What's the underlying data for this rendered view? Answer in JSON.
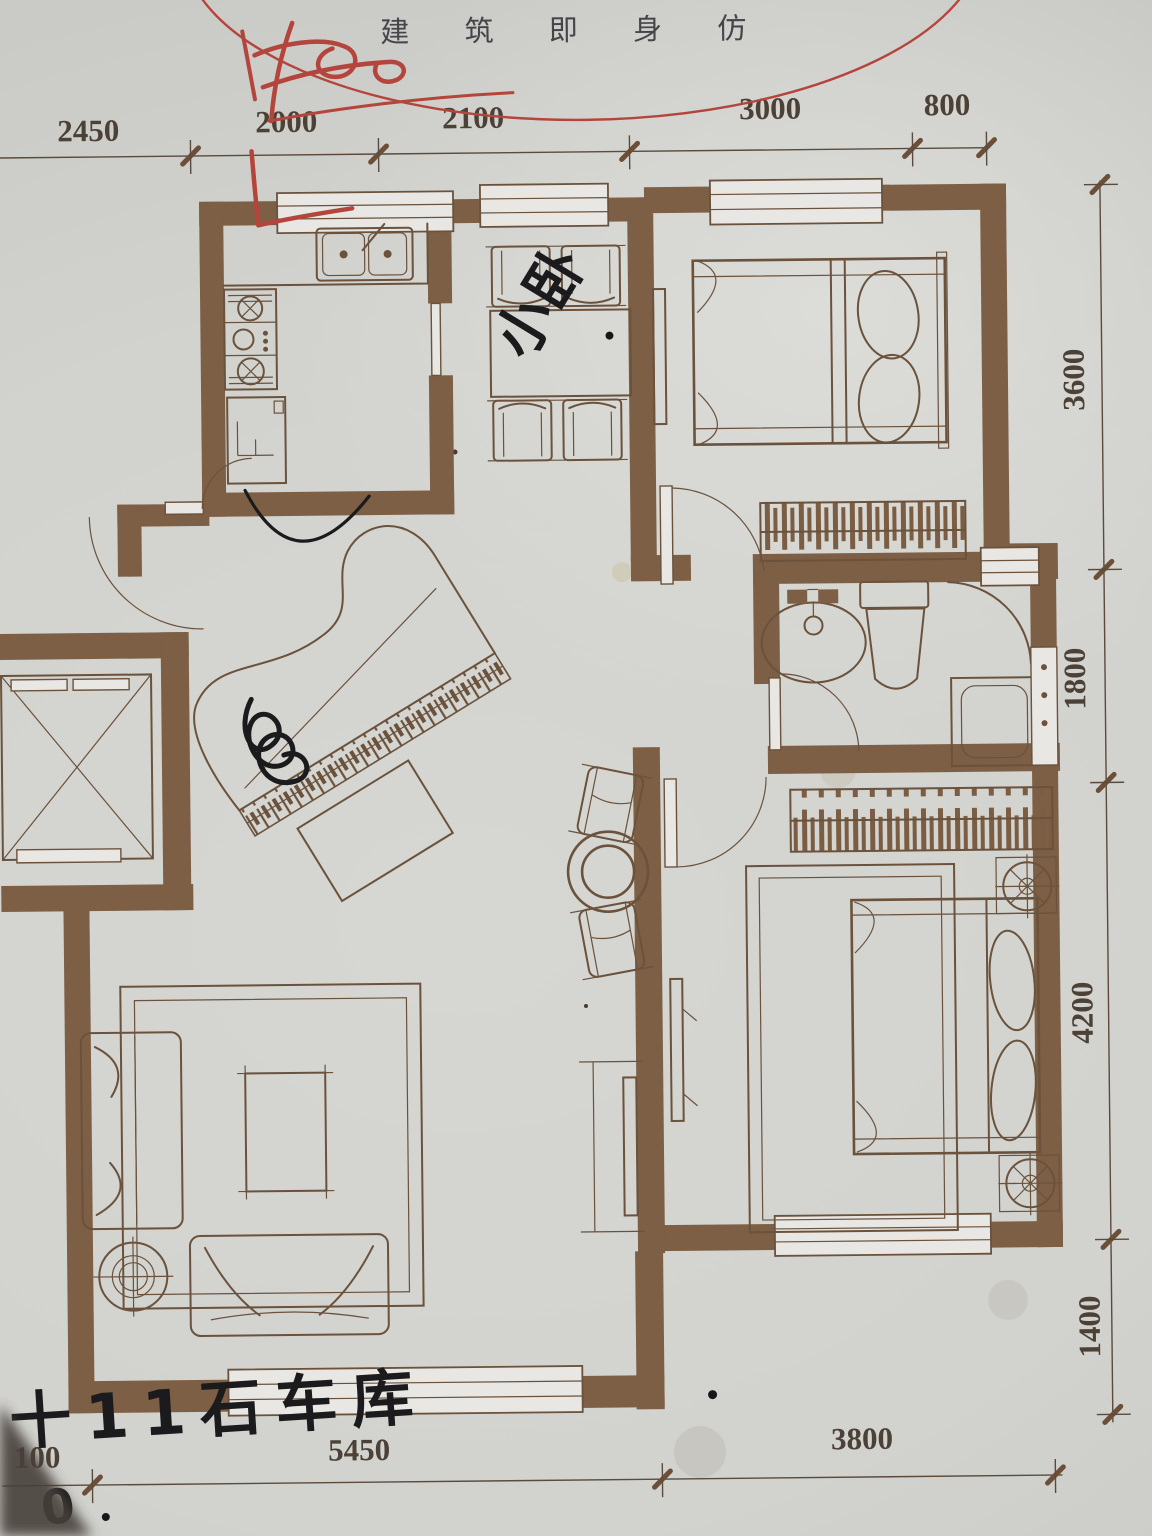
{
  "title": {
    "text": "建 筑 即 身 仿"
  },
  "dimensions": {
    "top": [
      "2450",
      "2000",
      "2100",
      "3000",
      "800"
    ],
    "right": [
      "3600",
      "1800",
      "4200",
      "1400"
    ],
    "bottom": [
      "100",
      "5450",
      "3800"
    ]
  },
  "annotations": {
    "dining_handwriting": "小卧",
    "garage_handwriting": "十11石车库",
    "zero_handwriting": "0"
  },
  "colors": {
    "paper": "#d5d5d1",
    "wall": "#7d5f45",
    "line": "#6a523c",
    "red": "#b4453c",
    "ink": "#1b1b1e"
  }
}
